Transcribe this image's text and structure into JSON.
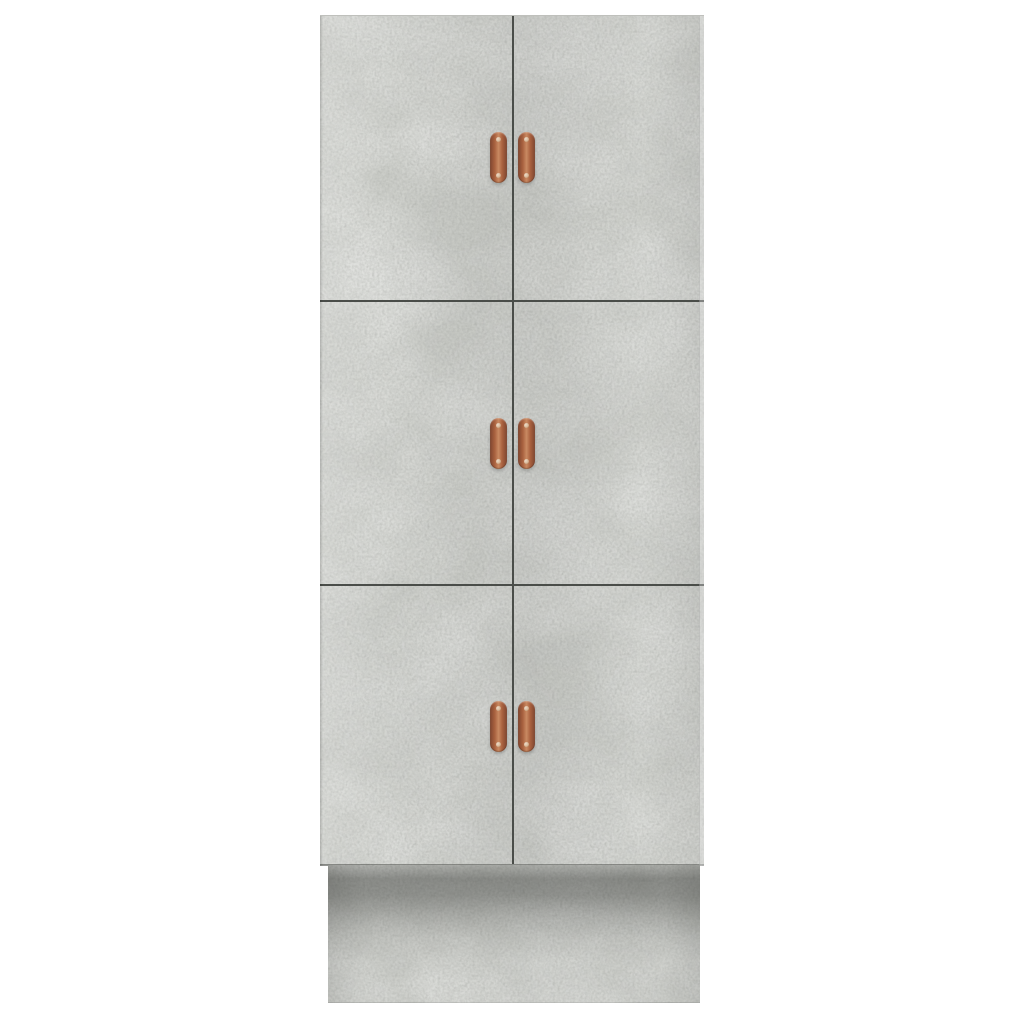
{
  "scene": {
    "type": "product photo",
    "description": "Tall concrete grey cabinet with six doors, copper pull handles and a recessed plinth base, photographed on a plain white background",
    "background_color": "#ffffff"
  },
  "cabinet": {
    "finish": "concrete grey",
    "door_count": 6,
    "handle_count": 6,
    "rows": [
      {
        "label": "top",
        "doors": [
          "top-left door",
          "top-right door"
        ]
      },
      {
        "label": "middle",
        "doors": [
          "middle-left door",
          "middle-right door"
        ]
      },
      {
        "label": "bottom",
        "doors": [
          "bottom-left door",
          "bottom-right door"
        ]
      }
    ],
    "handle_style": "vertical copper pull with a screw at each end",
    "base": "recessed plinth with cast shadow from the overhanging doors"
  },
  "colors": {
    "background": "#ffffff",
    "door_base": "#cbcdc8",
    "door_light": "#e0e1dd",
    "door_dark": "#a8aaa6",
    "seam": "#4a4d49",
    "plinth_base": "#c2c4bf",
    "shadow": "#2e302c",
    "handle_copper": "#a9613f",
    "handle_copper_light": "#c98a62",
    "handle_copper_dark": "#7e452f",
    "screw": "#eddcca"
  }
}
